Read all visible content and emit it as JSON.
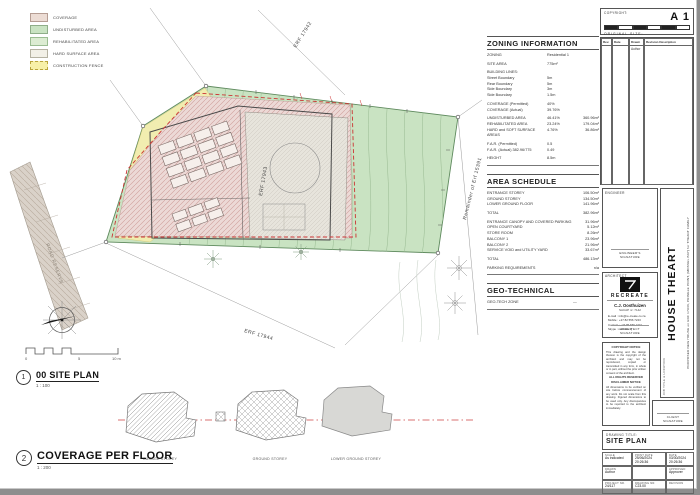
{
  "colors": {
    "undisturbed_green": "#c9e3c2",
    "coverage_pink": "#e8d2d0",
    "rehabilitated_yellow": "#f4eeb0",
    "road_tan": "#d9d1c8",
    "construction_fence_red": "#cc3333"
  },
  "legend": {
    "items": [
      {
        "label": "COVERAGE",
        "color": "#ecdcd4",
        "border_css": "0.5px solid #b59d93"
      },
      {
        "label": "UNDISTURBED AREA",
        "color": "#c9e3c2",
        "border_css": "0.5px solid #8fae89"
      },
      {
        "label": "REHABILITATED AREA",
        "color": "#dcecd2",
        "border_css": "0.5px solid #9bbd92"
      },
      {
        "label": "HARD SURFACE AREA",
        "color": "#f2f0e7",
        "border_css": "0.5px solid #b5b2a2"
      },
      {
        "label": "CONSTRUCTION FENCE",
        "color": "#f7f0a8",
        "border_css": "1px dashed #b9a43c"
      }
    ]
  },
  "plan": {
    "erf_main": "ERF 17943",
    "erf_top": "ERF 17942",
    "erf_bottom": "ERF 17944",
    "erf_right": "Remainder of Erf 15391",
    "road_label": "ROAD RESERVE",
    "scalebar": {
      "zero": "0",
      "five": "5",
      "ten": "10 m"
    }
  },
  "views": {
    "site": {
      "number": "1",
      "title": "00 SITE PLAN",
      "scale": "1 : 100"
    },
    "coverage": {
      "number": "2",
      "title": "COVERAGE PER FLOOR",
      "scale": "1 : 200"
    }
  },
  "floors": {
    "garage": "GARAGE STOREY",
    "ground": "GROUND STOREY",
    "lower": "LOWER GROUND STOREY"
  },
  "zoning": {
    "title": "ZONING INFORMATION",
    "rows": [
      {
        "label": "ZONING",
        "value": "Residential 1"
      },
      {
        "label": "SITE AREA",
        "value": "775m²",
        "gap": true
      },
      {
        "label": "BUILDING LINES:",
        "value": "",
        "gap": true
      },
      {
        "label": "Street Boundary",
        "value": "5m"
      },
      {
        "label": "Rear Boundary",
        "value": "5m"
      },
      {
        "label": "Side Boundary",
        "value": "3m"
      },
      {
        "label": "Side Boundary",
        "value": "1.5m"
      },
      {
        "label": "COVERAGE (Permitted)",
        "value": "40%",
        "gap": true
      },
      {
        "label": "COVERAGE (Actual)",
        "value": "39.76%"
      },
      {
        "label": "UNDISTURBED AREA",
        "value": "46.41%",
        "value2": "360.96m²",
        "gap": true
      },
      {
        "label": "REHABILITATED AREA",
        "value": "23.24%",
        "value2": "179.04m²"
      },
      {
        "label": "HARD and SOFT SURFACE AREAS",
        "value": "4.76%",
        "value2": "36.86m²"
      },
      {
        "label": "F.A.R.  (Permitted)",
        "value": "0.5",
        "gap": true
      },
      {
        "label": "F.A.R.  (Actual)   382.96/775",
        "value": "0.49"
      },
      {
        "label": "HEIGHT",
        "value": "8.5m",
        "gap": true
      }
    ]
  },
  "area": {
    "title": "AREA SCHEDULE",
    "rows": [
      {
        "label": "ENTRANCE STOREY",
        "value": "106.50m²"
      },
      {
        "label": "GROUND STOREY",
        "value": "134.50m²"
      },
      {
        "label": "LOWER GROUND FLOOR",
        "value": "141.96m²"
      },
      {
        "label": "TOTAL",
        "value": "382.96m²",
        "gap": true
      },
      {
        "label": "ENTRANCE CANOPY AND COVERED PARKING",
        "value": "31.96m²",
        "gap": true
      },
      {
        "label": "OPEN COURTYARD",
        "value": "5.12m²"
      },
      {
        "label": "STORE ROOM",
        "value": "8.26m²"
      },
      {
        "label": "BALCONY 1",
        "value": "23.96m²"
      },
      {
        "label": "BALCONY 2",
        "value": "21.96m²"
      },
      {
        "label": "SERVICE VOID and UTILITY YARD",
        "value": "33.67m²"
      },
      {
        "label": "TOTAL",
        "value": "486.13m²",
        "gap": true
      },
      {
        "label": "PARKING REQUIREMENTS",
        "value": "n/a",
        "gap": true
      }
    ]
  },
  "geo": {
    "title": "GEO-TECHNICAL",
    "rows": [
      {
        "label": "GEO-TECH ZONE",
        "value": "—"
      }
    ]
  },
  "titleblock": {
    "copyright_label": "COPYRIGHT:",
    "sheet_size": "A 1",
    "original_size_label": "ORIGINAL SIZE:",
    "rev_headers": [
      "Rev.",
      "Date",
      "Drawn",
      "Revision Description"
    ],
    "rev_drawn": "Author",
    "engineer_label": "ENGINEER",
    "engineer_signature": "ENGINEER'S SIGNATURE",
    "architect_label": "ARCHITECT",
    "firm_name": "RECREATE",
    "architect_name": "C.J. Oosthuizen",
    "architect_reg": "SACAP nr: 7142",
    "contact_lines": [
      "E-mail : info@re-create.co.za",
      "Mobile : +27 82 556 7243",
      "Contact : +27 86 566 2471",
      "Skype : recreate.cj"
    ],
    "architect_signature": "ARCHITECT SIGNATURE",
    "copyright_heading": "COPYRIGHT NOTICE",
    "copyright_body": "This drawing and the design thereon is the copyright of the architect and may not be reproduced, copied or transmitted in any form, in whole or in part, without the prior written consent of the architect.",
    "rights_line": "ALL RIGHTS RESERVED",
    "disclaimer_heading": "DISCLAIMER NOTICE",
    "disclaimer_body": "All dimensions to be verified on site before commencement of any work. Do not scale from this drawing. Figured dimensions to be used only. Any discrepancies to be reported to the architect immediately.",
    "client_signature": "CLIENT SIGNATURE",
    "job_title_label": "JOB TITLE & LOCATION",
    "project_name": "HOUSE THEART",
    "project_desc": "PROPOSED NEW HOUSE on ERF 17943, PRINGLE POINT, (MOSSEL BAY) for THEART FAMILY",
    "drawing_title_label": "DRAWING TITLE:",
    "drawing_title": "SITE PLAN",
    "info": {
      "scale_label": "SCALE",
      "scale": "As indicated",
      "print_date_label": "PRINT DATE",
      "print_date": "25/06/2024 20:26:36",
      "date_label": "DATE",
      "date": "03/30/2024 20:26:36",
      "drawn_label": "DRAWN",
      "drawn": "Author",
      "approved_label": "APPROVED",
      "approved": "Approver",
      "project_label": "PROJECT NR.",
      "project_nr": "24/117",
      "drawing_label": "DRAWING NR.",
      "drawing_nr": "C23.00",
      "revision_label": "REVISION",
      "revision": ""
    }
  }
}
